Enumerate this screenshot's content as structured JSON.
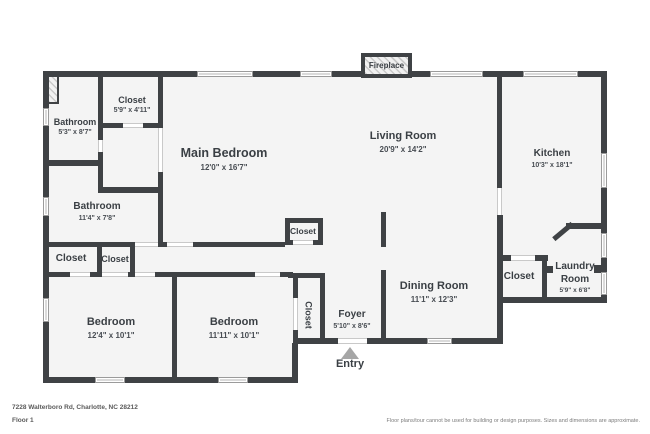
{
  "page": {
    "address": "7228 Walterboro Rd, Charlotte, NC 28212",
    "floor_label": "Floor 1",
    "disclaimer": "Floor plans/tour cannot be used for building or design purposes. Sizes and dimensions are approximate."
  },
  "plan": {
    "fireplace_label": "Fireplace",
    "entry_label": "Entry",
    "colors": {
      "wall": "#3f4245",
      "floor": "#f4f4f4",
      "text": "#3a3f44",
      "window_frame": "#9b9b9b",
      "entry_arrow": "#a6a6a6"
    },
    "rooms": [
      {
        "id": "bathroom-1",
        "name": "Bathroom",
        "dims": "5'3\" x 8'7\"",
        "x": 75,
        "y": 117,
        "name_size": 9,
        "dims_size": 7
      },
      {
        "id": "closet-top",
        "name": "Closet",
        "dims": "5'9\" x 4'11\"",
        "x": 132,
        "y": 95,
        "name_size": 9,
        "dims_size": 7
      },
      {
        "id": "main-bedroom",
        "name": "Main Bedroom",
        "dims": "12'0\" x 16'7\"",
        "x": 224,
        "y": 146,
        "name_size": 12.5,
        "dims_size": 8
      },
      {
        "id": "living-room",
        "name": "Living Room",
        "dims": "20'9\" x 14'2\"",
        "x": 403,
        "y": 130,
        "name_size": 11,
        "dims_size": 8
      },
      {
        "id": "kitchen",
        "name": "Kitchen",
        "dims": "10'3\" x 18'1\"",
        "x": 552,
        "y": 148,
        "name_size": 10,
        "dims_size": 7
      },
      {
        "id": "bathroom-2",
        "name": "Bathroom",
        "dims": "11'4\" x 7'8\"",
        "x": 97,
        "y": 201,
        "name_size": 10,
        "dims_size": 7
      },
      {
        "id": "closet-hall-left",
        "name": "Closet",
        "dims": "",
        "x": 71,
        "y": 253,
        "name_size": 10
      },
      {
        "id": "closet-hall-right",
        "name": "Closet",
        "dims": "",
        "x": 115,
        "y": 254,
        "name_size": 9
      },
      {
        "id": "closet-living",
        "name": "Closet",
        "dims": "",
        "x": 303,
        "y": 226,
        "name_size": 8.5
      },
      {
        "id": "dining-room",
        "name": "Dining Room",
        "dims": "11'1\" x 12'3\"",
        "x": 434,
        "y": 280,
        "name_size": 11,
        "dims_size": 8
      },
      {
        "id": "closet-laundry",
        "name": "Closet",
        "dims": "",
        "x": 519,
        "y": 271,
        "name_size": 10
      },
      {
        "id": "laundry-room",
        "name": "Laundry Room",
        "dims": "5'9\" x 6'8\"",
        "x": 575,
        "y": 261,
        "name_size": 10,
        "dims_size": 6.5,
        "wrap": 56
      },
      {
        "id": "bedroom-1",
        "name": "Bedroom",
        "dims": "12'4\" x 10'1\"",
        "x": 111,
        "y": 316,
        "name_size": 11,
        "dims_size": 8
      },
      {
        "id": "bedroom-2",
        "name": "Bedroom",
        "dims": "11'11\" x 10'1\"",
        "x": 234,
        "y": 316,
        "name_size": 11,
        "dims_size": 8
      },
      {
        "id": "closet-bedroom2",
        "name": "Closet",
        "dims": "",
        "x": 308,
        "y": 315,
        "name_size": 9,
        "vertical": true
      },
      {
        "id": "foyer",
        "name": "Foyer",
        "dims": "5'10\" x 8'6\"",
        "x": 352,
        "y": 309,
        "name_size": 10,
        "dims_size": 7
      }
    ]
  }
}
